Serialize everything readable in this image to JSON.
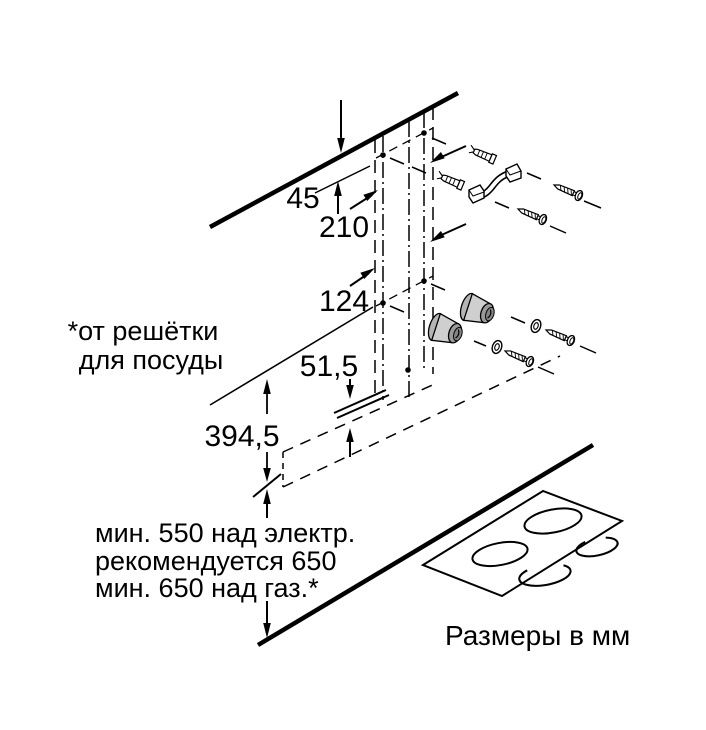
{
  "diagram": {
    "dimensions": {
      "top_offset": "45",
      "upper_spacing": "210",
      "lower_spacing": "124",
      "bottom_gap": "51,5",
      "body_height": "394,5"
    },
    "footnote": {
      "line1": "*от решётки",
      "line2": "для посуды"
    },
    "clearance": {
      "line1": "мин. 550 над электр.",
      "line2": "рекомендуется 650",
      "line3": "мин. 650 над газ.*"
    },
    "units_note": "Размеры в мм",
    "colors": {
      "line": "#000000",
      "spacer_gray": "#a8a8a8",
      "background": "#ffffff"
    }
  }
}
